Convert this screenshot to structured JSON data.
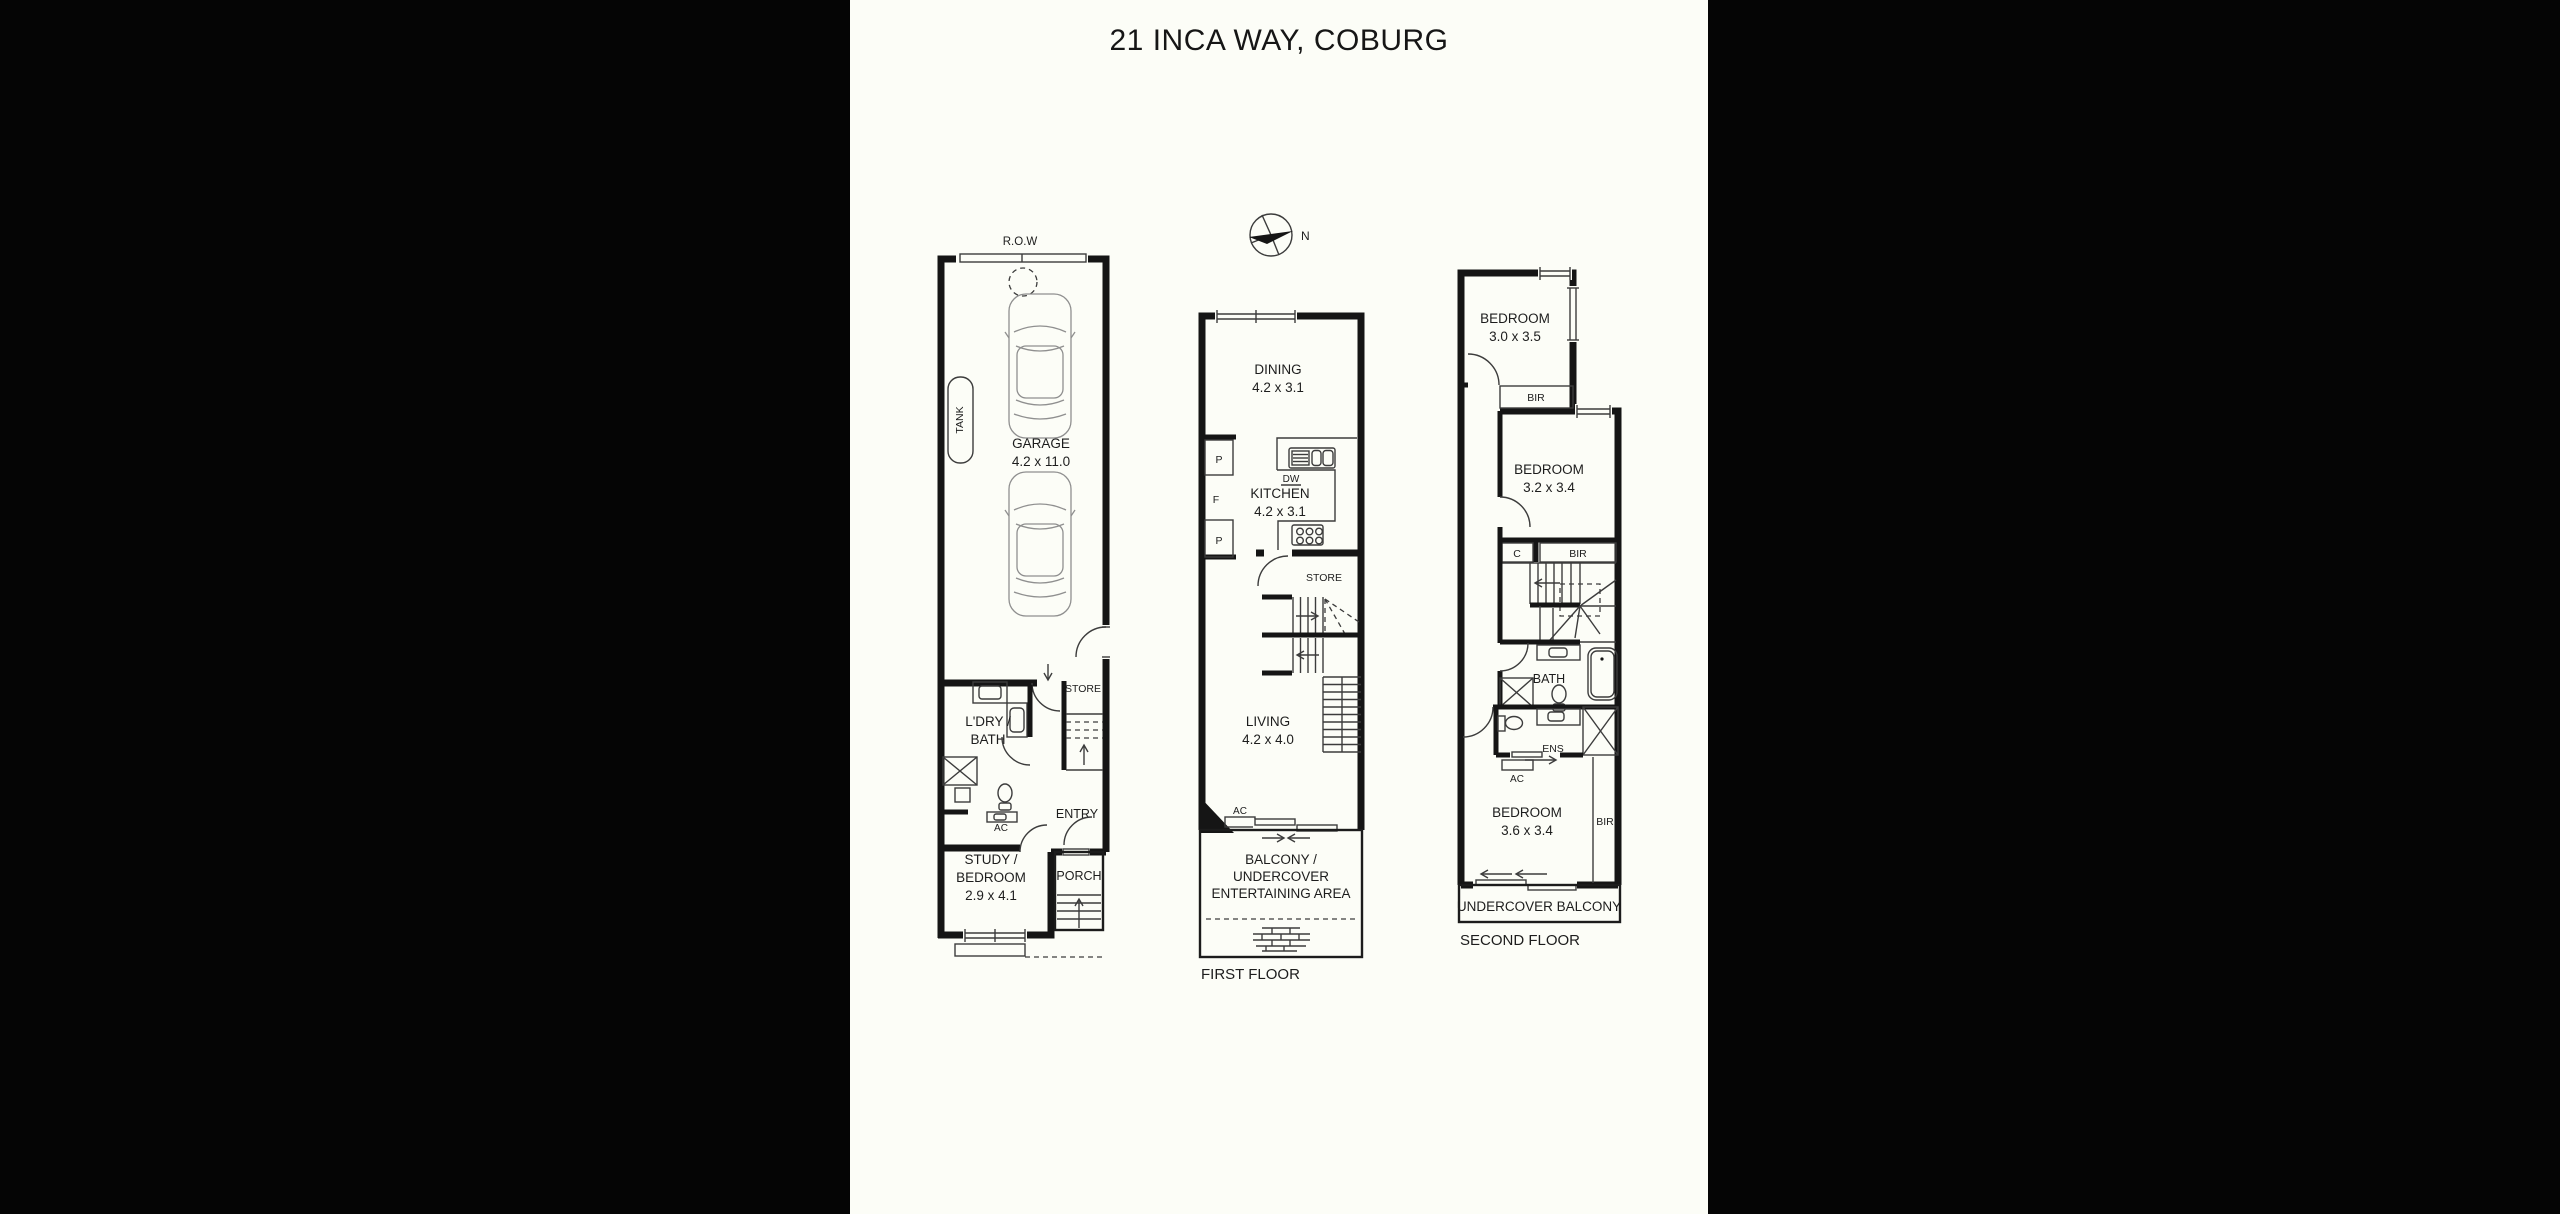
{
  "title": "21 INCA WAY, COBURG",
  "compass": {
    "north_label": "N"
  },
  "ground_floor": {
    "row": "R.O.W",
    "tank": "TANK",
    "garage": "GARAGE",
    "garage_dims": "4.2 x 11.0",
    "store": "STORE",
    "laundry_line1": "L'DRY /",
    "laundry_line2": "BATH",
    "ac": "AC",
    "entry": "ENTRY",
    "study_line1": "STUDY /",
    "study_line2": "BEDROOM",
    "study_dims": "2.9 x 4.1",
    "porch": "PORCH"
  },
  "first_floor": {
    "label": "FIRST FLOOR",
    "dining": "DINING",
    "dining_dims": "4.2 x 3.1",
    "pantry1": "P",
    "fridge": "F",
    "pantry2": "P",
    "dw": "DW",
    "kitchen": "KITCHEN",
    "kitchen_dims": "4.2 x 3.1",
    "store": "STORE",
    "living": "LIVING",
    "living_dims": "4.2 x 4.0",
    "ac": "AC",
    "balcony_line1": "BALCONY /",
    "balcony_line2": "UNDERCOVER",
    "balcony_line3": "ENTERTAINING AREA"
  },
  "second_floor": {
    "label": "SECOND FLOOR",
    "bedroom1": "BEDROOM",
    "bedroom1_dims": "3.0 x 3.5",
    "bir1": "BIR",
    "bedroom2": "BEDROOM",
    "bedroom2_dims": "3.2 x 3.4",
    "closet": "C",
    "bir2": "BIR",
    "bath": "BATH",
    "ens": "ENS",
    "ac": "AC",
    "bedroom3": "BEDROOM",
    "bedroom3_dims": "3.6 x 3.4",
    "bir3": "BIR",
    "balcony": "UNDERCOVER BALCONY"
  }
}
